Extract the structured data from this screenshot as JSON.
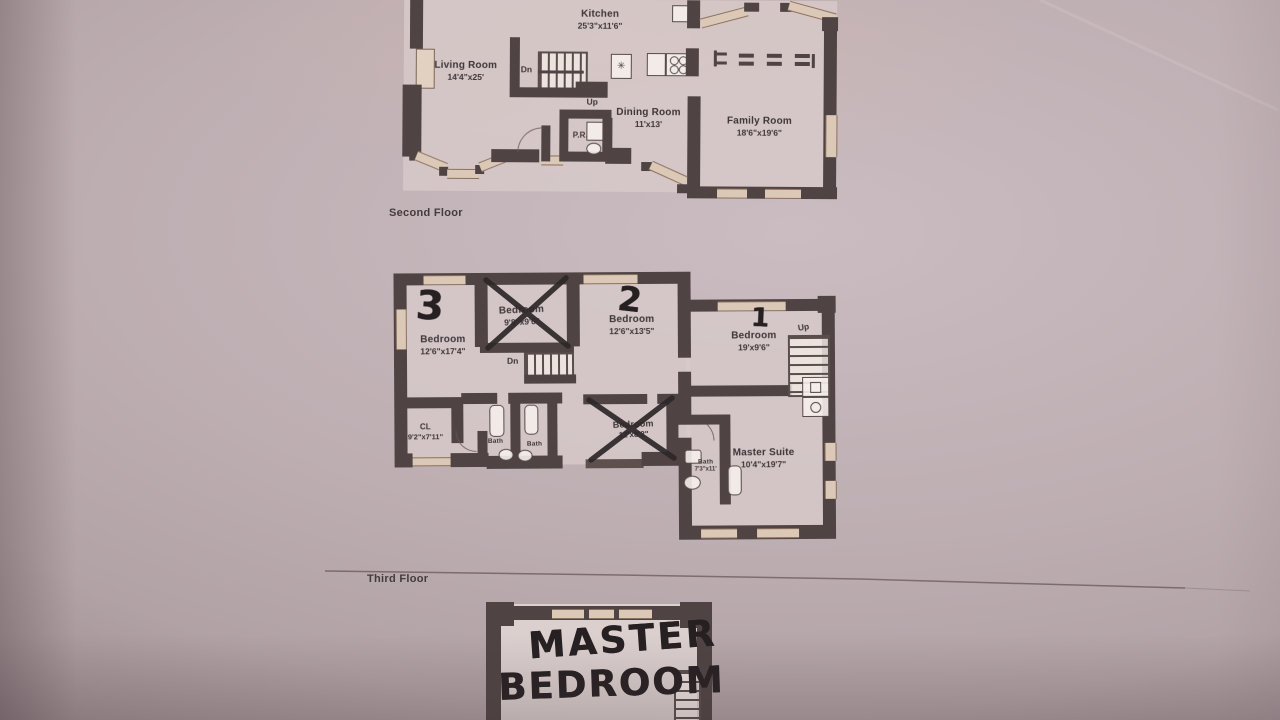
{
  "floors": {
    "second": {
      "label": "Second Floor",
      "kitchen_name": "Kitchen",
      "kitchen_dims": "25'3\"x11'6\"",
      "living_name": "Living Room",
      "living_dims": "14'4\"x25'",
      "dining_name": "Dining Room",
      "dining_dims": "11'x13'",
      "family_name": "Family Room",
      "family_dims": "18'6\"x19'6\"",
      "pr": "P.R.",
      "up": "Up",
      "dn": "Dn"
    },
    "third": {
      "label": "Third Floor",
      "bedroom3_num": "3",
      "bedroom3_name": "Bedroom",
      "bedroom3_dims": "12'6\"x17'4\"",
      "bedroomx1_name": "Bedroom",
      "bedroomx1_dims": "9'8\"x9'6\"",
      "bedroom2_num": "2",
      "bedroom2_name": "Bedroom",
      "bedroom2_dims": "12'6\"x13'5\"",
      "bedroom1_num": "1",
      "bedroom1_name": "Bedroom",
      "bedroom1_dims": "19'x9'6\"",
      "cl_name": "CL",
      "cl_dims": "9'2\"x7'11\"",
      "bath1": "Bath",
      "bath2": "Bath",
      "bedroomx2_name": "Bedroom",
      "bedroomx2_dims": "12'x8'2\"",
      "bath3_name": "Bath",
      "bath3_dims": "7'3\"x11'",
      "master_name": "Master Suite",
      "master_dims": "10'4\"x19'7\"",
      "up": "Up",
      "dn": "Dn"
    },
    "fourth": {
      "hand_line1": "MASTER",
      "hand_line2": "BEDROOM"
    }
  },
  "icons": {
    "fan": "✳"
  },
  "colors": {
    "paper": "#bdaeb2",
    "wall": "#4f4443",
    "ink": "#3d3537",
    "marker": "#262022"
  }
}
